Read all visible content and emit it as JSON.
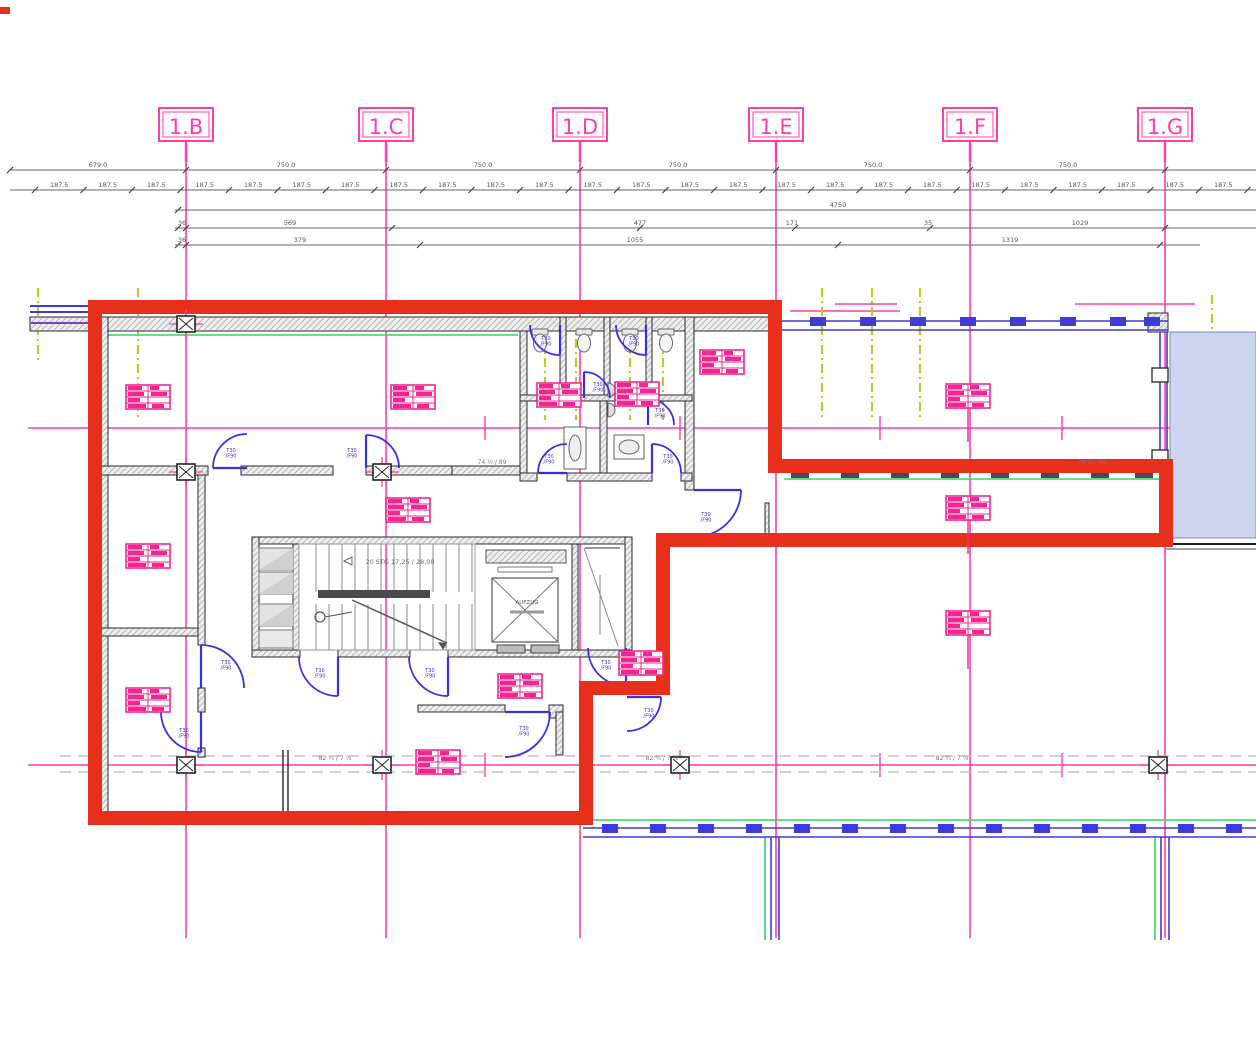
{
  "drawing": {
    "grid": {
      "labels": [
        "1.B",
        "1.C",
        "1.D",
        "1.E",
        "1.F",
        "1.G"
      ]
    },
    "dimensions": {
      "bays": [
        "679.0",
        "750.0",
        "750.0",
        "750.0",
        "750.0",
        "750.0"
      ],
      "unit": "187.5",
      "total": "4750",
      "segments_a": [
        "36",
        "569",
        "477",
        "171",
        "35",
        "1029"
      ],
      "segments_b": [
        "36",
        "379",
        "1055",
        "1319"
      ],
      "plan_dim_a": "74 ½ / 89",
      "plan_dim_b": "82 ¾ / 7 ⅞"
    },
    "stair_note": "20 STG 17,25 / 28,00",
    "elevator_label": "AUFZUG",
    "door_tag": {
      "line1": "T30",
      "line2": "/F90"
    },
    "colors": {
      "selection_red": "#e7301c",
      "grid_pink": "#ff3da6",
      "stamp_pink": "#f3258e",
      "door_blue": "#3b2fe6",
      "facade_blue": "#3f3ad8",
      "line_green": "#35cf68",
      "datum_olive": "#b8cc2e",
      "glazing_fill": "#ccd4ee",
      "wall_dark": "#2a2a2a",
      "dim_gray": "#555555"
    }
  }
}
